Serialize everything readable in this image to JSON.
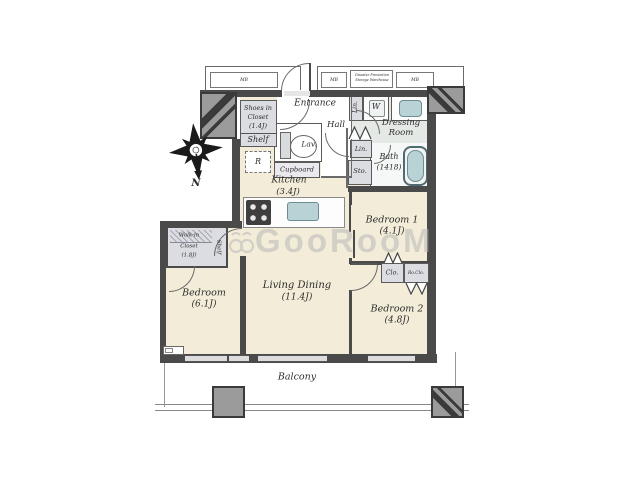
{
  "compass": {
    "north_label": "N"
  },
  "watermark": {
    "text": "GooRooM"
  },
  "corridor": {
    "mb_left": "MB",
    "mb_mid": "MB",
    "mb_right": "MB",
    "storage_line1": "Disaster Prevention",
    "storage_line2": "Storage Warehouse"
  },
  "rooms": {
    "entrance": {
      "label": "Entrance"
    },
    "hall": {
      "label": "Hall"
    },
    "shoes_closet": {
      "line1": "Shoes in",
      "line2": "Closet",
      "line3": "(1.4J)",
      "shelf_label": "Shelf"
    },
    "lavatory": {
      "label": "Lav."
    },
    "cupboard": {
      "label": "Cupboard"
    },
    "refrigerator": {
      "label": "R"
    },
    "kitchen": {
      "name": "Kitchen",
      "size": "(3.4J)"
    },
    "linen_upper": {
      "label": "Lin."
    },
    "washer": {
      "label": "W"
    },
    "dressing_room": {
      "line1": "Dressing",
      "line2": "Room"
    },
    "linen_lower": {
      "label": "Lin."
    },
    "storage": {
      "label": "Sto."
    },
    "bath": {
      "name": "Bath",
      "size": "(1418)"
    },
    "bedroom1": {
      "name": "Bedroom 1",
      "size": "(4.1J)"
    },
    "bedroom2": {
      "name": "Bedroom 2",
      "size": "(4.8J)"
    },
    "bedroom_main": {
      "name": "Bedroom",
      "size": "(6.1J)"
    },
    "living_dining": {
      "name": "Living Dining",
      "size": "(11.4J)"
    },
    "walkin_closet": {
      "line1": "Walk-in",
      "line2": "Closet",
      "line3": "(1.8J)",
      "shelf_label": "Shelf"
    },
    "closet": {
      "label": "Clo."
    },
    "closet_small": {
      "label": "Ro.Clo."
    },
    "balcony": {
      "label": "Balcony"
    }
  },
  "colors": {
    "floor_beige": "#f2ecd8",
    "wall_dark": "#4a4a4a",
    "closet_lavender": "#dcdde3",
    "dressing_bg": "#e4e9e6",
    "fixture_teal": "#b9d2d6",
    "pillar_gray": "#9b9b9b"
  }
}
